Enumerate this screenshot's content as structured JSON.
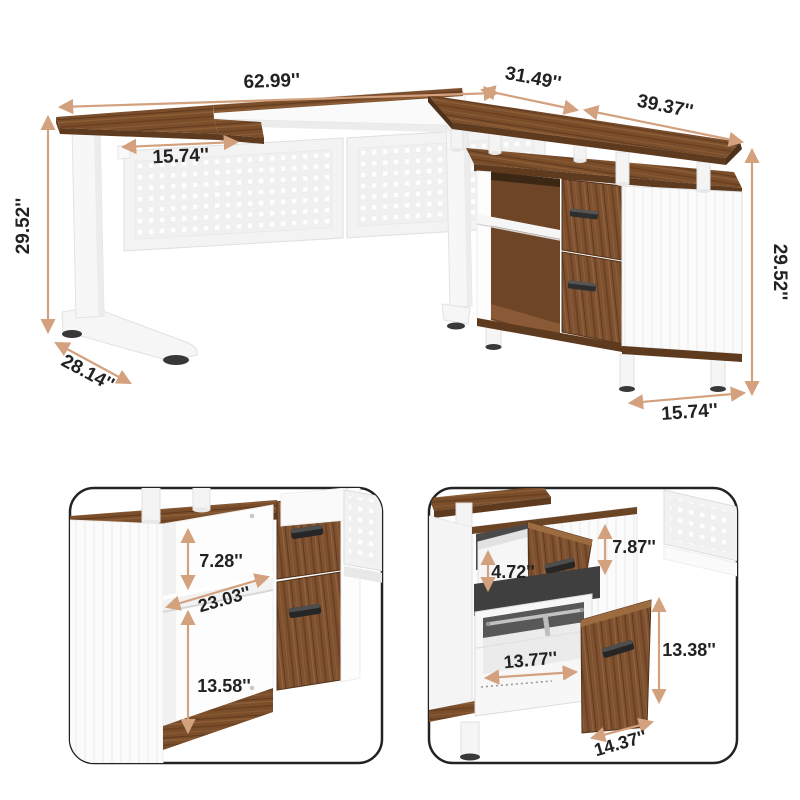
{
  "product_view": {
    "dimensions": {
      "desk_length": "62.99''",
      "corner_return_length": "31.49''",
      "side_desk_length": "39.37''",
      "desktop_return_depth": "15.74''",
      "desk_height_left": "29.52''",
      "leg_foot_depth": "28.14''",
      "desk_height_right": "29.52''",
      "cabinet_end_depth": "15.74''"
    }
  },
  "shelf_detail_view": {
    "dimensions": {
      "upper_compartment_height": "7.28''",
      "compartment_width": "23.03''",
      "lower_compartment_height": "13.58''"
    }
  },
  "drawer_detail_view": {
    "dimensions": {
      "top_drawer_inner_height": "4.72''",
      "upper_section_height": "7.87''",
      "file_drawer_front_height": "13.38''",
      "file_drawer_inner_width": "13.77''",
      "file_drawer_front_width": "14.37''"
    }
  },
  "style": {
    "arrow_color": "#d3a17e",
    "wood_color": "#7b4e2b",
    "text_color": "#222222"
  }
}
